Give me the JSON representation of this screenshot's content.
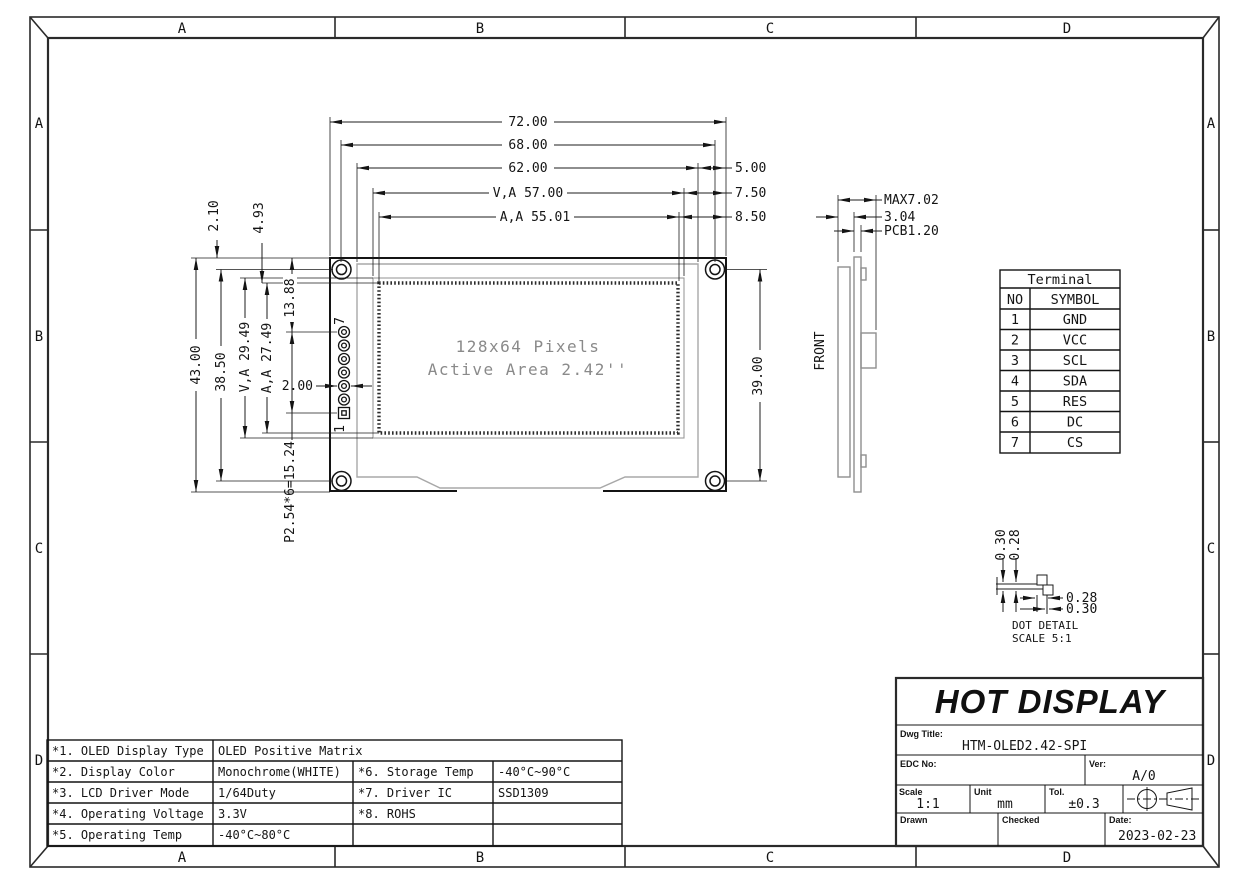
{
  "zone_letters": {
    "top": [
      "A",
      "B",
      "C",
      "D"
    ],
    "bottom": [
      "A",
      "B",
      "C",
      "D"
    ],
    "left": [
      "A",
      "B",
      "C",
      "D"
    ],
    "right": [
      "A",
      "B",
      "C",
      "D"
    ]
  },
  "front_view": {
    "display_line1": "128x64 Pixels",
    "display_line2": "Active Area 2.42''",
    "pin_top_label": "7",
    "pin_bottom_label": "1",
    "dim_width_pcb": "72.00",
    "dim_width_holes": "68.00",
    "dim_width_bezel": "62.00",
    "dim_width_va": "V,A 57.00",
    "dim_width_aa": "A,A 55.01",
    "dim_right_bezel_gap": "5.00",
    "dim_right_va_gap": "7.50",
    "dim_right_aa_gap": "8.50",
    "dim_height_pcb": "43.00",
    "dim_height_holes": "38.50",
    "dim_height_va": "V,A 29.49",
    "dim_height_aa": "A,A 27.49",
    "dim_top_margin": "2.10",
    "dim_aa_offset": "4.93",
    "dim_pin7_offset": "13.88",
    "dim_pin_pitch": "P2.54*6=15.24",
    "dim_pin_dia": "2.00",
    "dim_hole_span_v": "39.00"
  },
  "side_view": {
    "front_label": "FRONT",
    "dim_max_thickness": "MAX7.02",
    "dim_module": "3.04",
    "dim_pcb_thickness": "PCB1.20"
  },
  "terminal_table": {
    "title": "Terminal",
    "header_no": "NO",
    "header_symbol": "SYMBOL",
    "rows": [
      [
        "1",
        "GND"
      ],
      [
        "2",
        "VCC"
      ],
      [
        "3",
        "SCL"
      ],
      [
        "4",
        "SDA"
      ],
      [
        "5",
        "RES"
      ],
      [
        "6",
        "DC"
      ],
      [
        "7",
        "CS"
      ]
    ]
  },
  "dot_detail": {
    "dim_v_outer": "0.30",
    "dim_v_inner": "0.28",
    "dim_h_inner": "0.28",
    "dim_h_outer": "0.30",
    "title": "DOT DETAIL",
    "scale": "SCALE 5:1"
  },
  "spec_table": {
    "rows": [
      [
        "*1. OLED Display Type",
        "OLED Positive Matrix",
        "",
        ""
      ],
      [
        "*2. Display Color",
        "Monochrome(WHITE)",
        "*6. Storage Temp",
        "-40°C~90°C"
      ],
      [
        "*3. LCD Driver Mode",
        "1/64Duty",
        "*7. Driver IC",
        "SSD1309"
      ],
      [
        "*4. Operating Voltage",
        "3.3V",
        "*8. ROHS",
        ""
      ],
      [
        "*5. Operating Temp",
        "-40°C~80°C",
        "",
        ""
      ]
    ]
  },
  "title_block": {
    "company": "HOT DISPLAY",
    "dwg_title_label": "Dwg Title:",
    "dwg_title": "HTM-OLED2.42-SPI",
    "edc_label": "EDC No:",
    "ver_label": "Ver:",
    "ver_value": "A/0",
    "scale_label": "Scale",
    "scale_value": "1:1",
    "unit_label": "Unit",
    "unit_value": "mm",
    "tol_label": "Tol.",
    "tol_value": "±0.3",
    "drawn_label": "Drawn",
    "checked_label": "Checked",
    "date_label": "Date:",
    "date_value": "2023-02-23"
  }
}
